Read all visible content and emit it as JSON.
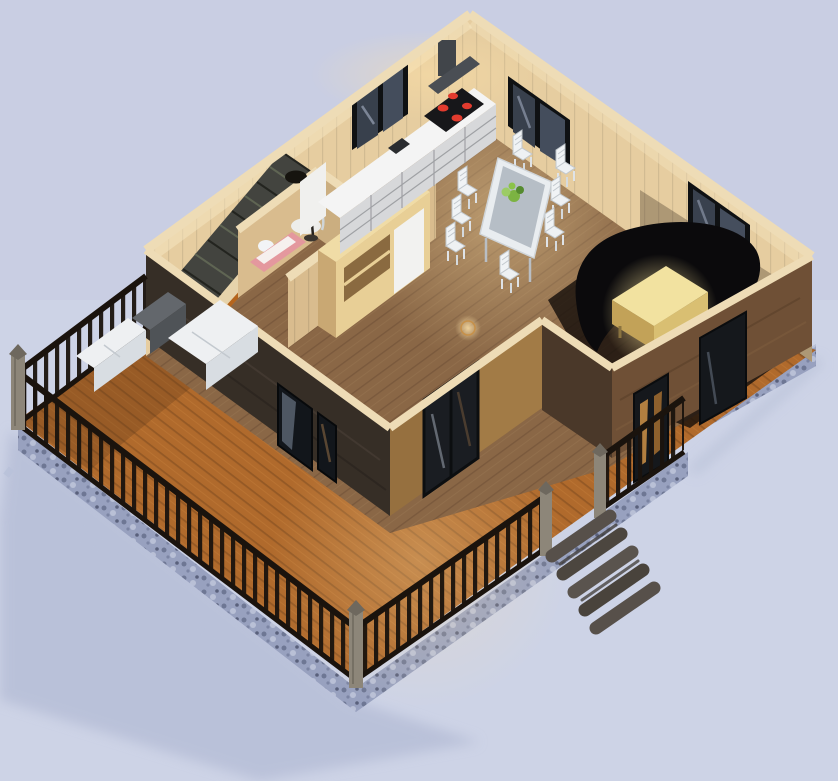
{
  "meta": {
    "type": "3d-architectural-render",
    "description": "Isometric 3D cutaway floor plan render of a single-storey wooden cabin with open-plan kitchen, dining area, curved black sofa living corner, staircase, bathroom, and a wrap-around timber deck with black balustrade railing on a stone foundation",
    "width": 838,
    "height": 781
  },
  "scene": {
    "objects": [
      "kitchen counter with cooktop and range hood",
      "dining table with white chairs and plant centerpiece",
      "black curved corner sofa",
      "glowing wooden coffee table",
      "staircase with handrail",
      "bathroom with curved glass shower",
      "media cabinet against partition wall",
      "arc floor lamp",
      "round floor light spot",
      "window openings with black frames",
      "wrap-around wooden deck",
      "black balustrade railing with timber posts",
      "outdoor white lounge modules",
      "log entry steps",
      "stone foundation",
      "ground shadow"
    ]
  },
  "colors": {
    "background": "#cdd3e6",
    "shadow": "#aab3cf",
    "deck": "#b06a2c",
    "foundation": "#98a1bf",
    "wallDark": "#362e26",
    "wallGold": "#96703f",
    "wingDark": "#4a3829",
    "wingFace": "#6f5036",
    "cutEdge": "#eedcb6",
    "interiorWall": "#e6cda0",
    "interiorFloor": "#8a6746",
    "counterTop": "#f4f4f4",
    "cabinet": "#d7d8da",
    "hood": "#41454a",
    "stove": "#17171a",
    "burner": "#e23b2e",
    "chair": "#f0f3f5",
    "tableTop": "#e9edf0",
    "glass": "#9fa9b4",
    "plant": "#7cb342",
    "sofa": "#0b0a0c",
    "coffeeTable": "#f2e2a0",
    "stairs": "#43443f",
    "stairRail": "#b5651d",
    "railing": "#1a130d",
    "post": "#8d8679",
    "lounge": "#eef0f2",
    "loungeDark": "#63676c",
    "stepLog": "#57504a",
    "windowFrame": "#0f1113",
    "windowGlass": "#38404c",
    "partition": "#d9bc8e",
    "cabinetWood": "#e8cf96"
  }
}
